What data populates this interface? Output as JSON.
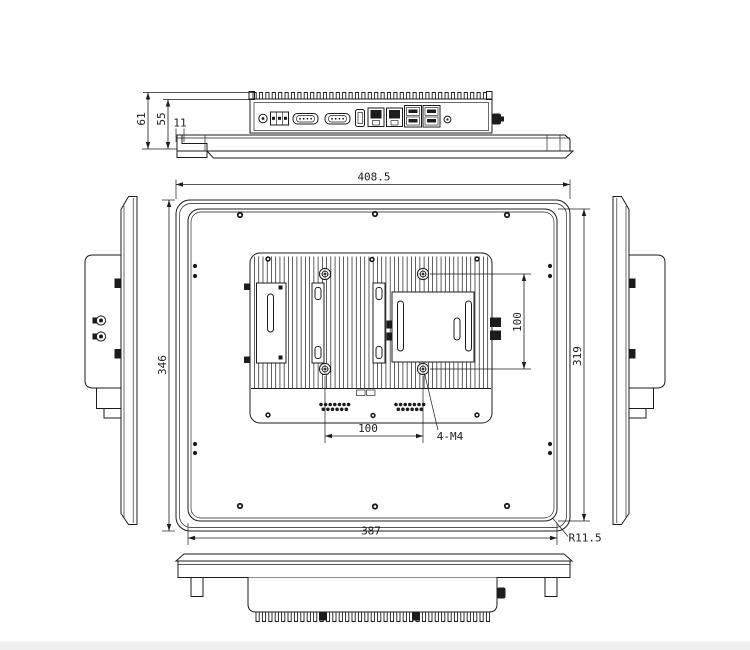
{
  "page": {
    "background": "#ffffff",
    "footer_band_color": "#f0f0f0"
  },
  "drawing": {
    "type": "mechanical-dimension-drawing",
    "subject": "industrial-panel-pc",
    "line_color": "#1c1c1c",
    "dims": {
      "overall_width": "408.5",
      "overall_height": "346",
      "rear_cover_width": "387",
      "rear_cover_height": "319",
      "vesa_vertical": "100",
      "vesa_horizontal": "100",
      "vesa_holes": "4-M4",
      "corner_radius": "R11.5",
      "total_depth": "61",
      "chassis_depth": "55",
      "bezel_lip": "11"
    },
    "ports": [
      "power-jack",
      "terminal-block",
      "com-port-1",
      "com-port-2",
      "hdmi-port",
      "lan-port-1",
      "lan-port-2",
      "usb-stack-1",
      "usb-stack-2",
      "audio-jack",
      "antenna-connector"
    ]
  }
}
